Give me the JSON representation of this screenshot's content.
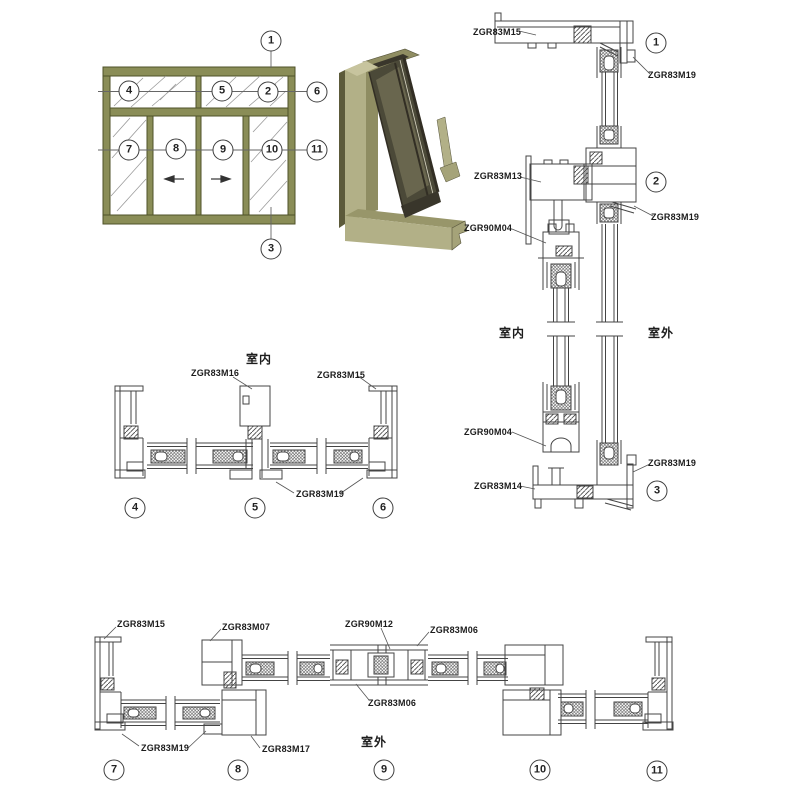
{
  "drawing_title": "aluminum-sliding-window-section-details",
  "colors": {
    "line": "#444444",
    "leader": "#555555",
    "frame_olive": "#8a8d57",
    "frame_olive_dark": "#4f5229",
    "iso_light": "#b2b087",
    "iso_mid": "#8f8d62",
    "iso_dark": "#5c5a3a",
    "iso_glass": "#4b4938",
    "iso_bronze": "#322e24"
  },
  "balloons": {
    "elevation": [
      "1",
      "2",
      "3",
      "4",
      "5",
      "6",
      "7",
      "8",
      "9",
      "10",
      "11"
    ],
    "vertical_section": [
      "1",
      "2",
      "3"
    ],
    "horizontal_top": [
      "4",
      "5",
      "6"
    ],
    "horizontal_bottom": [
      "7",
      "8",
      "9",
      "10",
      "11"
    ]
  },
  "labels": {
    "vertical": [
      "ZGR83M15",
      "ZGR83M19",
      "ZGR83M13",
      "ZGR83M19",
      "ZGR90M04",
      "室内",
      "室外",
      "ZGR90M04",
      "ZGR83M19",
      "ZGR83M14"
    ],
    "horizontal_top": [
      "室内",
      "ZGR83M16",
      "ZGR83M15",
      "ZGR83M19"
    ],
    "horizontal_bottom": [
      "ZGR83M15",
      "ZGR83M07",
      "ZGR90M12",
      "ZGR83M06",
      "ZGR83M06",
      "ZGR83M19",
      "ZGR83M17",
      "室外"
    ]
  }
}
